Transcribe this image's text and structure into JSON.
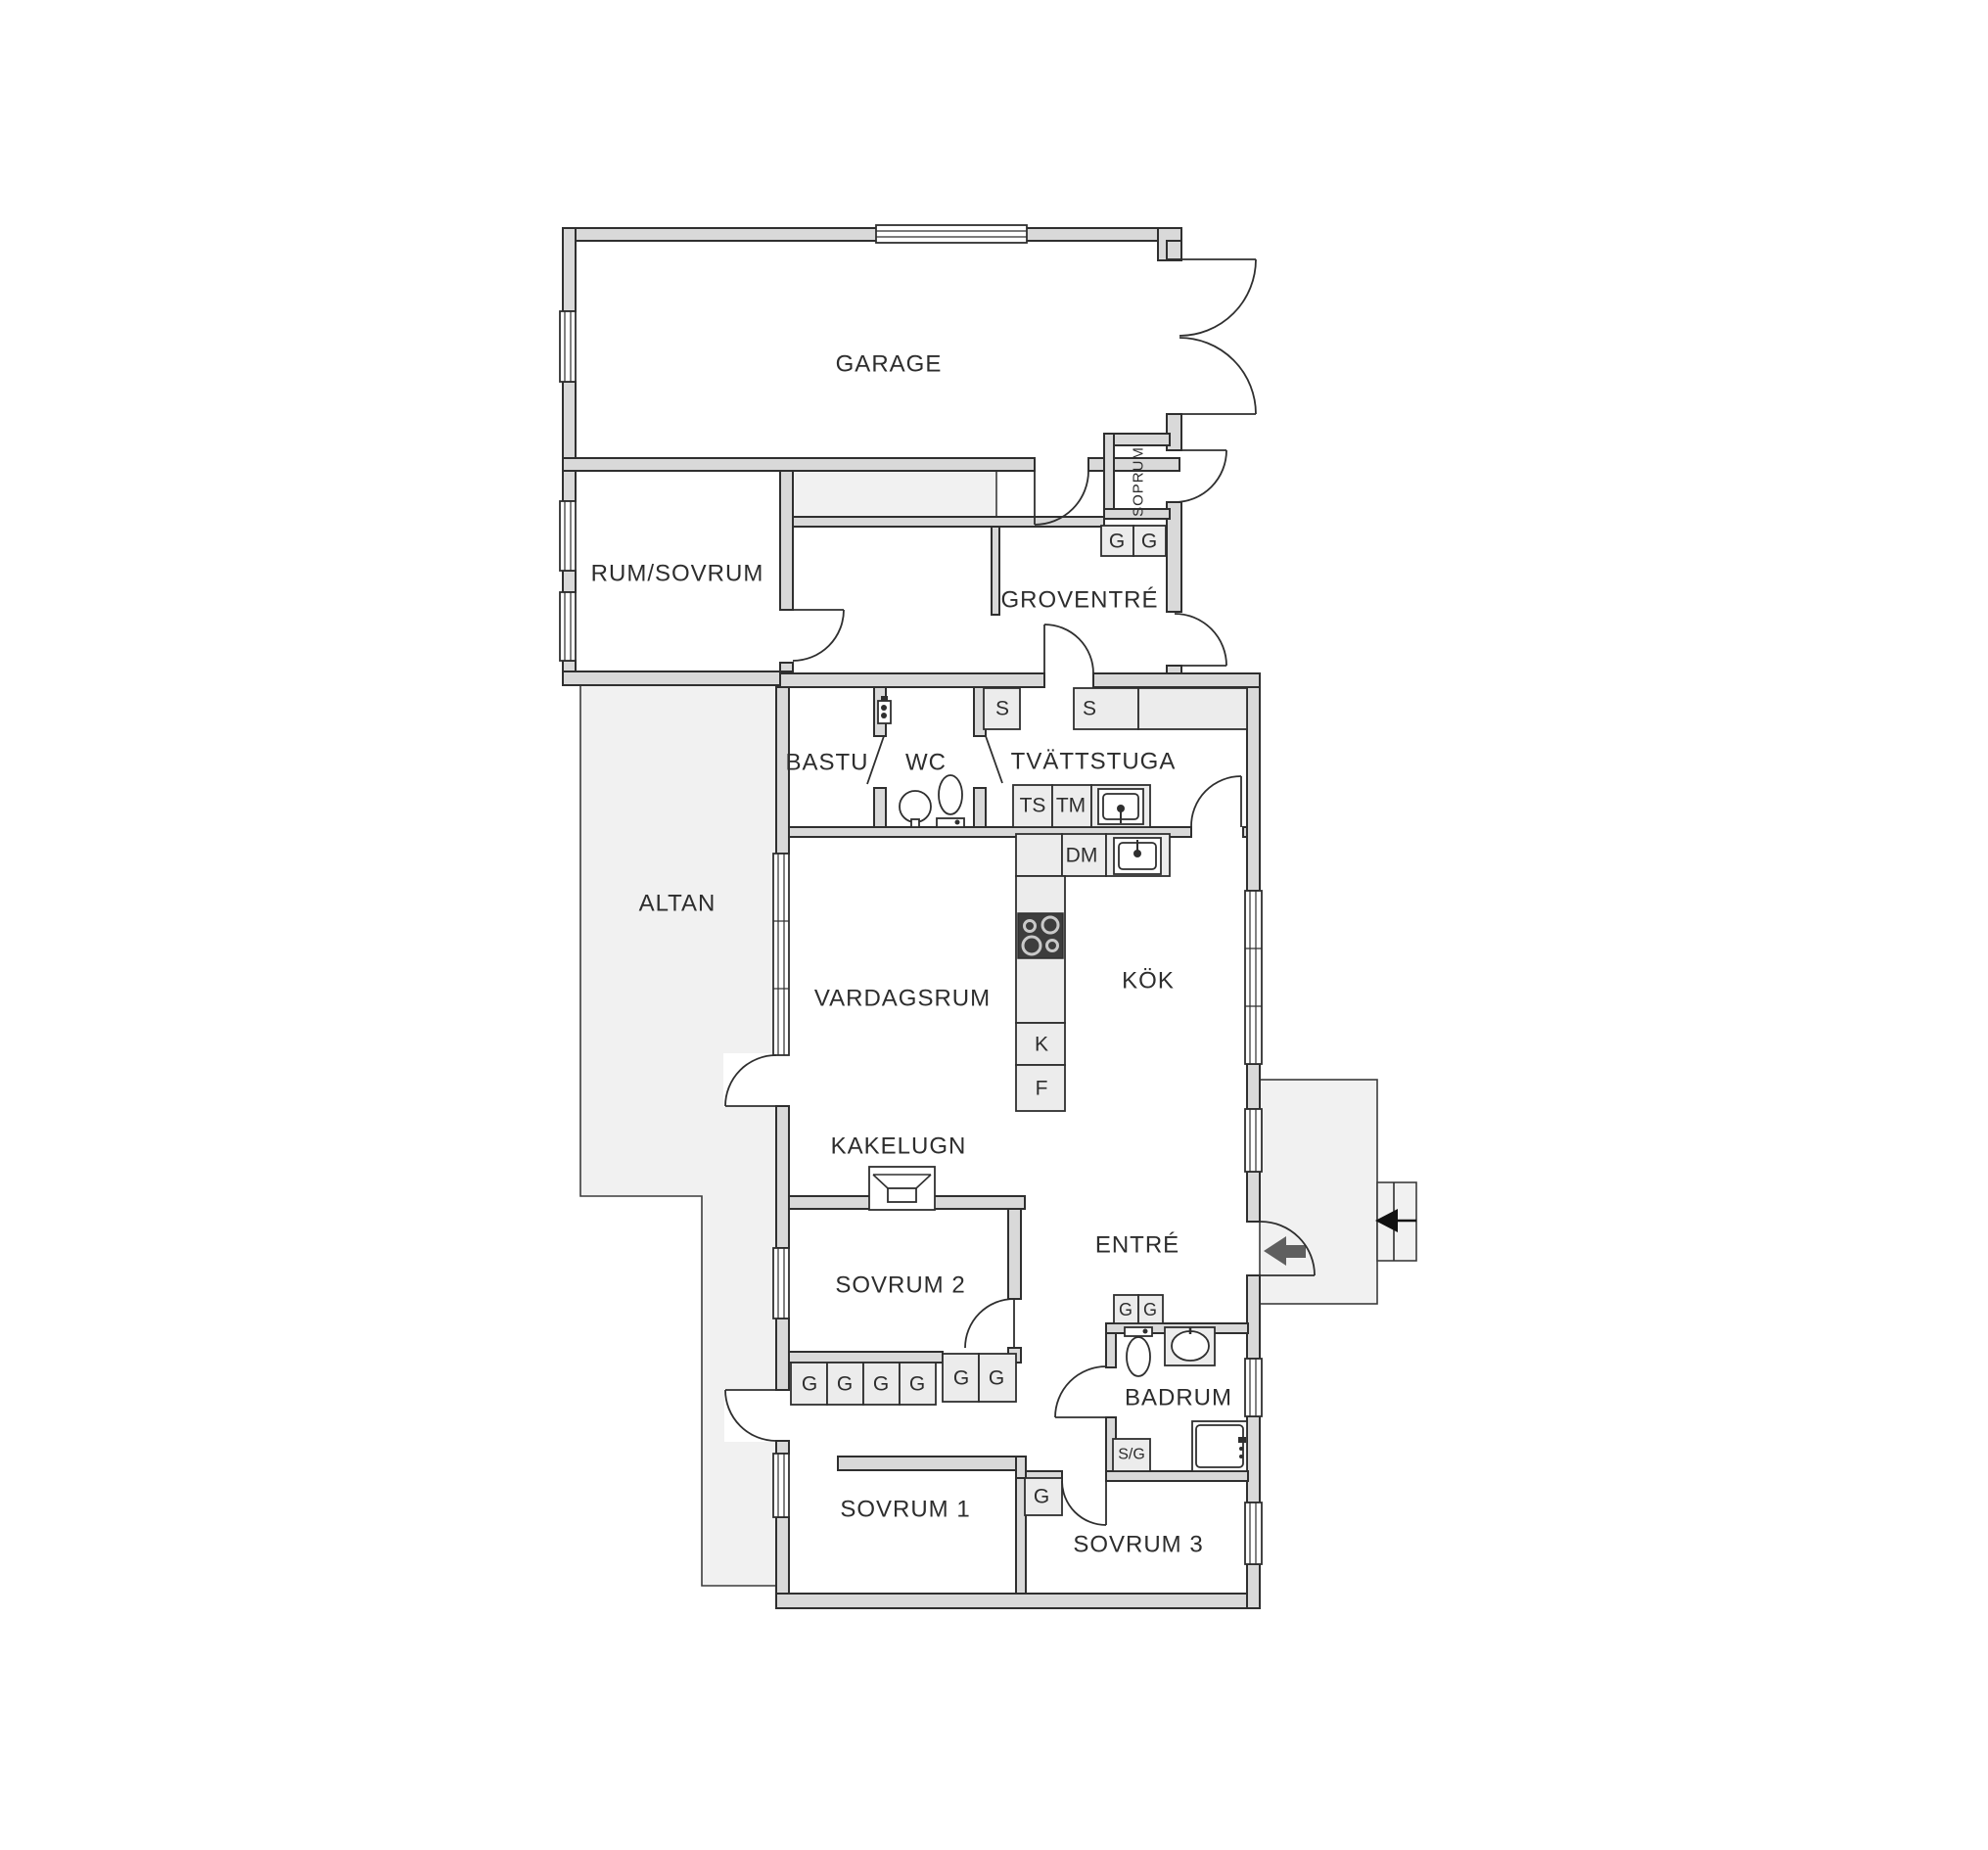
{
  "meta": {
    "type": "floor-plan",
    "language": "sv"
  },
  "rooms": {
    "garage": {
      "label": "GARAGE"
    },
    "rum_sovrum": {
      "label": "RUM/SOVRUM"
    },
    "soprum": {
      "label": "SOPRUM"
    },
    "groventre": {
      "label": "GROVENTRÉ"
    },
    "bastu": {
      "label": "BASTU"
    },
    "wc": {
      "label": "WC"
    },
    "tvattstuga": {
      "label": "TVÄTTSTUGA"
    },
    "altan": {
      "label": "ALTAN"
    },
    "vardagsrum": {
      "label": "VARDAGSRUM"
    },
    "kok": {
      "label": "KÖK"
    },
    "kakelugn": {
      "label": "KAKELUGN"
    },
    "sovrum2": {
      "label": "SOVRUM 2"
    },
    "entre": {
      "label": "ENTRÉ"
    },
    "badrum": {
      "label": "BADRUM"
    },
    "sovrum1": {
      "label": "SOVRUM 1"
    },
    "sovrum3": {
      "label": "SOVRUM 3"
    }
  },
  "cells": {
    "g": "G",
    "s": "S",
    "sg": "S/G",
    "ts": "TS",
    "tm": "TM",
    "dm": "DM",
    "k": "K",
    "f": "F"
  },
  "colors": {
    "background": "#ffffff",
    "wall_fill": "#d9d9d9",
    "wall_outline": "#2f2f2f",
    "deck_fill": "#f1f1f1",
    "closet_fill": "#ececec",
    "text": "#2d2d2d",
    "stove": "#3d3d3d",
    "entry_arrow": "#5f5f5f",
    "exterior_arrow": "#111111"
  }
}
